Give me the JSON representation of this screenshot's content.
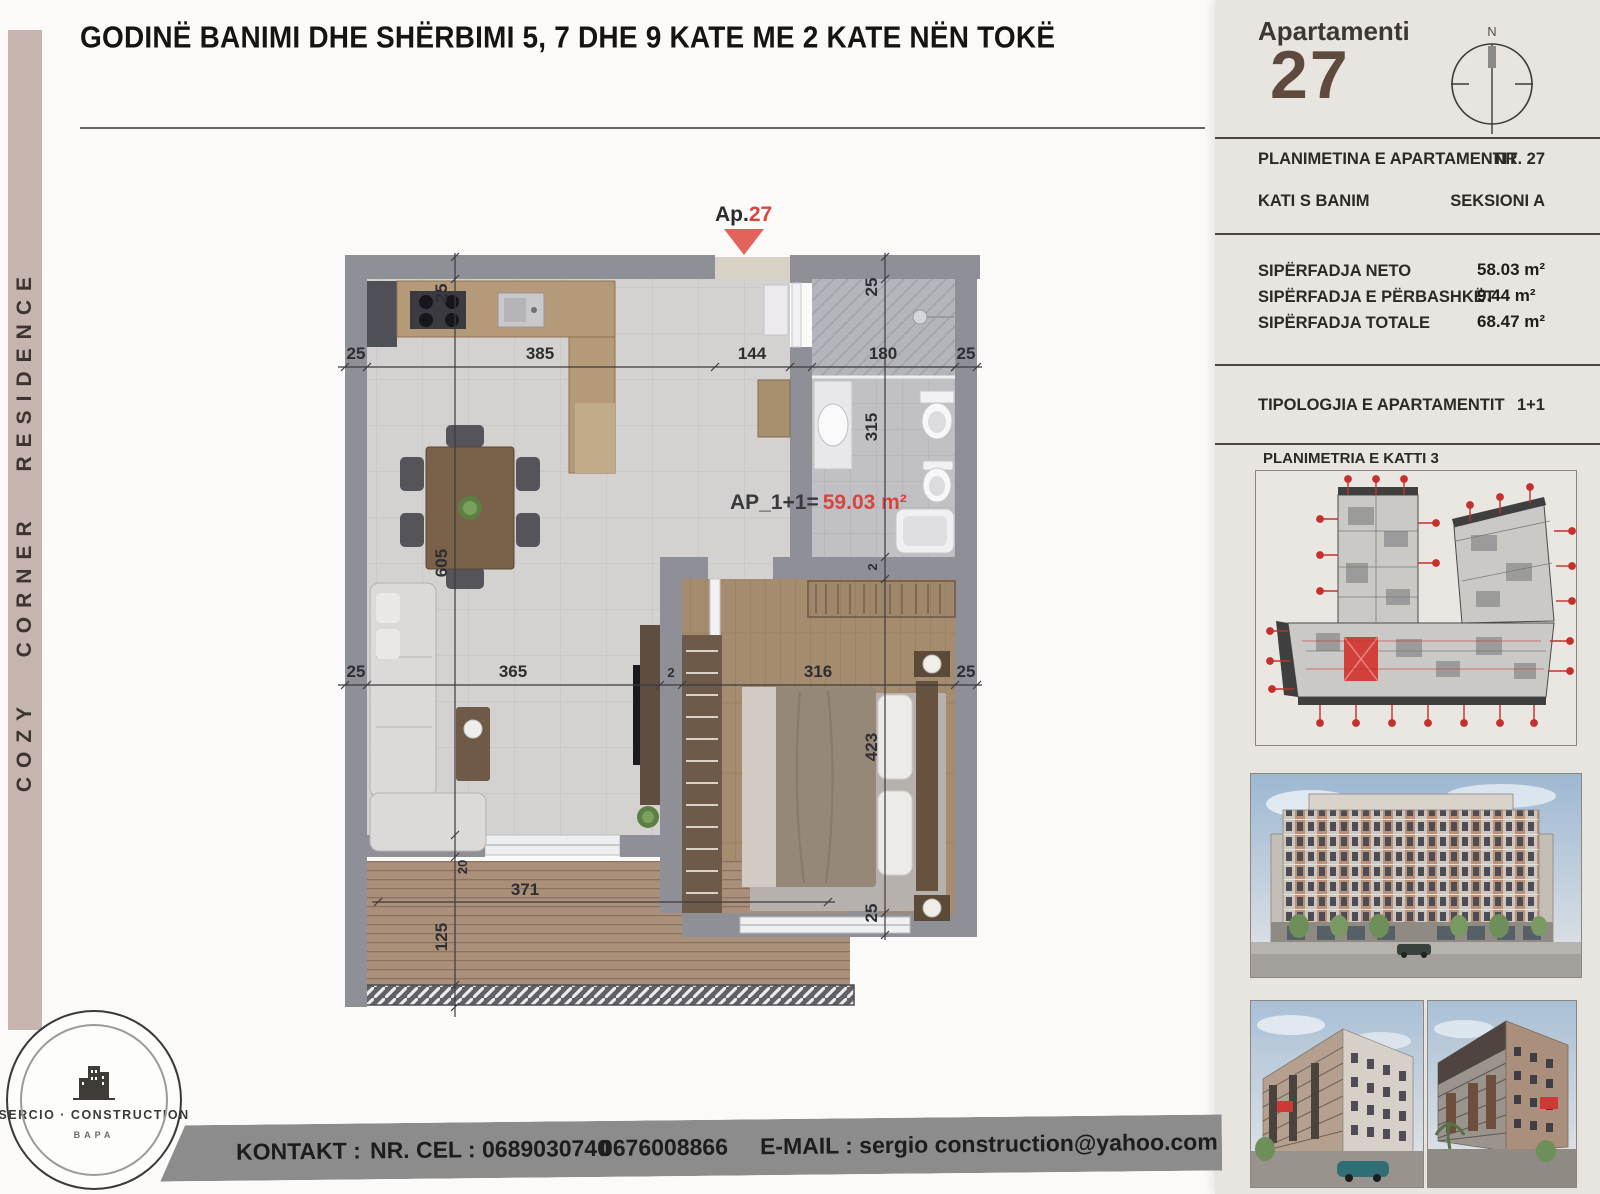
{
  "header": {
    "title": "GODINË BANIMI DHE SHËRBIMI 5, 7 DHE 9 KATE ME 2 KATE NËN TOKË",
    "banner": "COZY CORNER RESIDENCE"
  },
  "panel": {
    "apartment_label": "Apartamenti",
    "apartment_number": "27",
    "compass_n": "N",
    "info_rows": [
      {
        "label": "PLANIMETINA E APARTAMENTIT",
        "value": "NR. 27"
      },
      {
        "label": "KATI S BANIM",
        "value": "SEKSIONI A"
      }
    ],
    "area_rows": [
      {
        "label": "SIPËRFADJA NETO",
        "value": "58.03 m²"
      },
      {
        "label": "SIPËRFADJA E PËRBASHKËT",
        "value": "9.44 m²"
      },
      {
        "label": "SIPËRFADJA TOTALE",
        "value": "68.47 m²"
      }
    ],
    "typology_label": "TIPOLOGJIA E APARTAMENTIT",
    "typology_value": "1+1",
    "keyplan_title": "PLANIMETRIA E KATTI 3"
  },
  "plan": {
    "marker_prefix": "Ap.",
    "marker_number": "27",
    "area_prefix": "AP_1+1=",
    "area_value": "59.03 m²",
    "dims": {
      "top_left_wall": "25",
      "kitchen_width": "385",
      "entry_width": "144",
      "bath_width": "180",
      "top_right_wall": "25",
      "left_wall_top": "25",
      "living_height": "605",
      "bath_top_wall": "25",
      "bath_height": "315",
      "mid_left_wall": "25",
      "living_width": "365",
      "mid_gap": "2",
      "bedroom_width": "316",
      "mid_right_wall": "25",
      "small_gap": "2",
      "bedroom_height": "423",
      "bedroom_bottom_wall": "25",
      "door_depth": "20",
      "balcony_width": "371",
      "balcony_height": "125"
    }
  },
  "contact": {
    "label": "KONTAKT :",
    "phone": "NR. CEL : 0689030740",
    "phone2": "0676008866",
    "email": "E-MAIL : sergio construction@yahoo.com"
  },
  "logo": {
    "line1": "SERCIO · CONSTRUCTION",
    "line2": "BAPA"
  },
  "colors": {
    "accent_red": "#d8453f",
    "brown": "#5e4a3e",
    "mauve": "#c6b4af",
    "wall_gray": "#8f8f97",
    "bar_gray": "#8c8c8c"
  }
}
